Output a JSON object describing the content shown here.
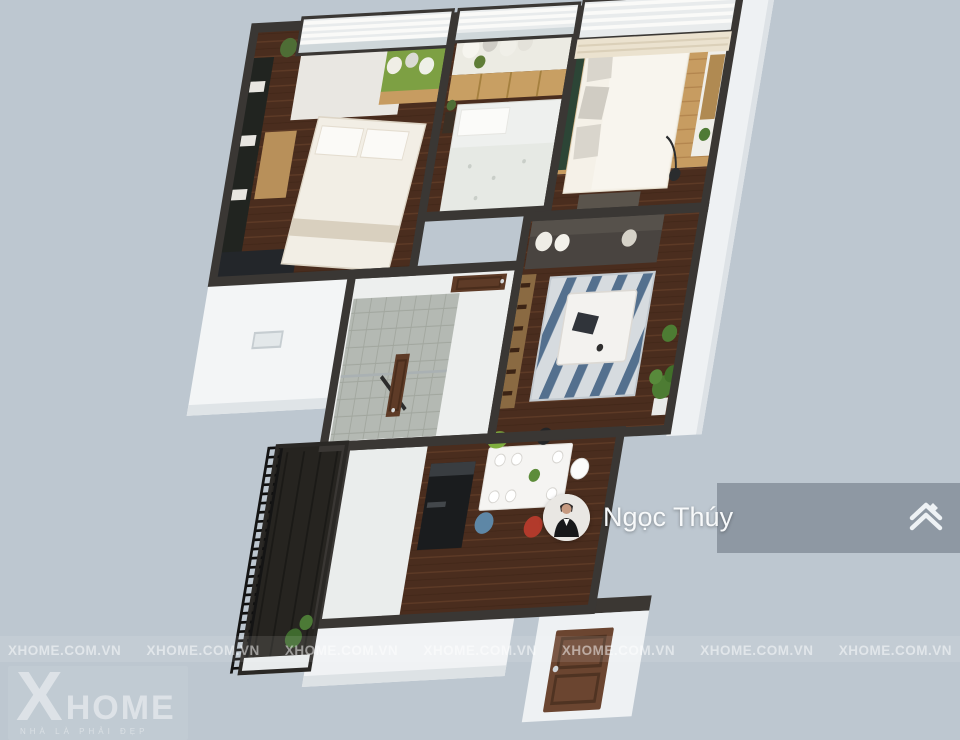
{
  "scene": {
    "type": "3d-apartment-floorplan-render",
    "rooms": [
      "bedroom-1",
      "bedroom-2",
      "master-bedroom",
      "living-room",
      "bathroom-hall",
      "kitchen-dining",
      "balcony",
      "entry-door"
    ]
  },
  "overlay": {
    "user_name": "Ngọc Thúy",
    "avatar_icon": "person-avatar",
    "action_icon": "stacked-home-icon"
  },
  "watermark": {
    "text": "XHOME.COM.VN",
    "count": 7
  },
  "brand": {
    "mark": "X",
    "name": "HOME",
    "tagline": "NHÀ LÀ PHẢI ĐẸP"
  },
  "palette": {
    "background": "#bdc7d0",
    "overlay_band": "#77828e",
    "wall": "#3a3734",
    "wood_floor": "#4a2d1e",
    "light_wood": "#c79c61",
    "white_wall": "#f2f4f5",
    "accent_green": "#7fae3e",
    "watermark_white": "#ffffff"
  }
}
